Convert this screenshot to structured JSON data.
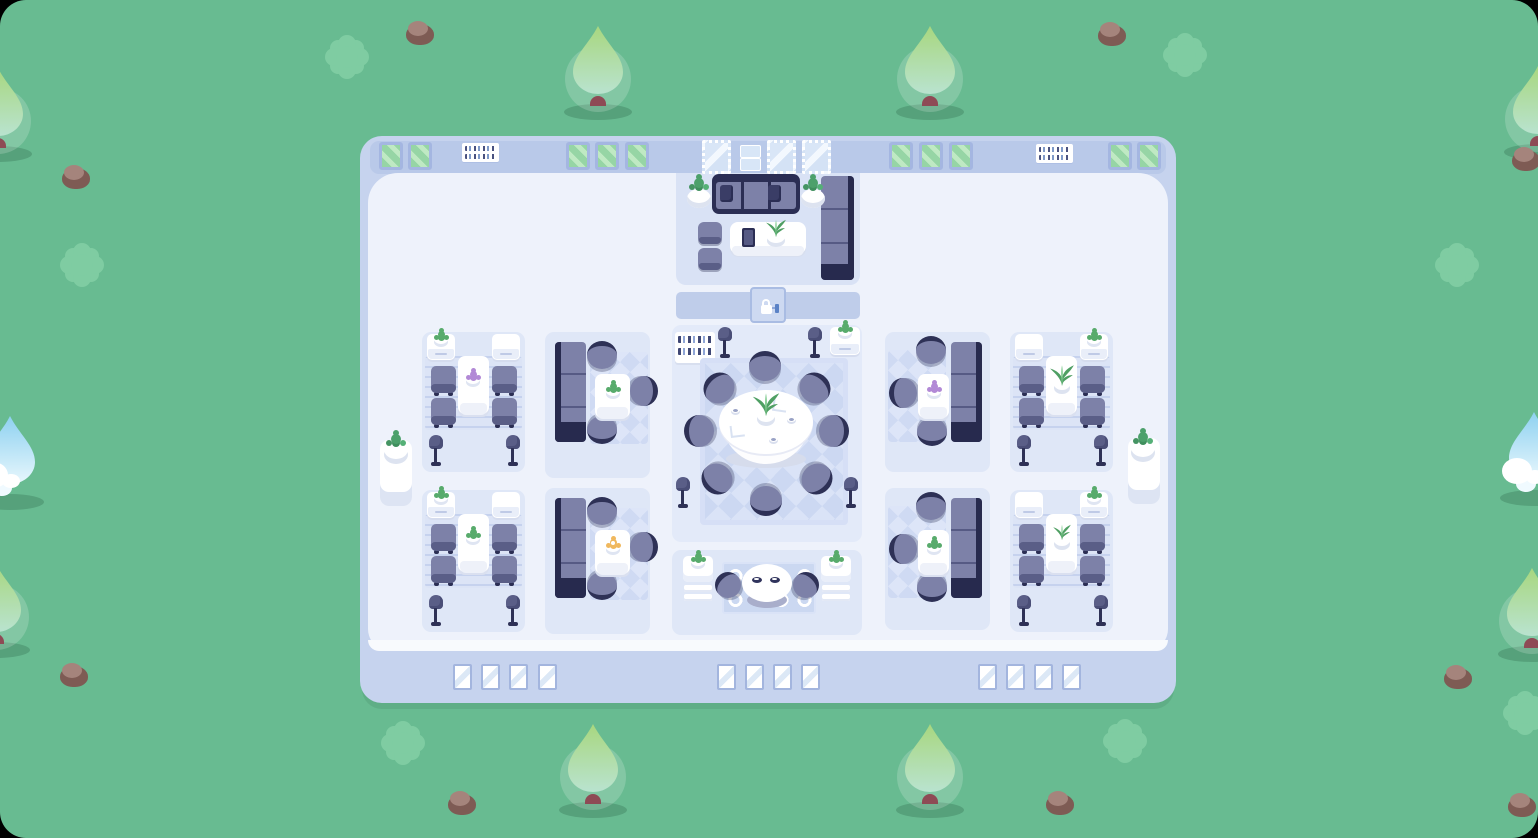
{
  "scene": {
    "title": "Top-down cozy office building on a grass field",
    "view": "top-down game map"
  },
  "environment": {
    "ground": "grass",
    "tree_count": 8,
    "cloud_tree_count": 2,
    "bush_count": 7,
    "rock_count": 9
  },
  "palette": {
    "grass": "#68BB91",
    "bush": "#7FCCA2",
    "tree_canopy_top": "#A8D77F",
    "tree_canopy_bottom": "#B9E3CF",
    "tree_trunk": "#8E4A55",
    "rock_light": "#A5847C",
    "rock_dark": "#7E5B54",
    "building_shell": "#C6D3EE",
    "wall_band": "#B9C9E9",
    "floor": "#EEF2FB",
    "room_panel": "#DFE7F7",
    "lounge_floor": "#D9E2F5",
    "window_green": "#96D5A5",
    "window_frame": "#A4B6E1",
    "furniture_purple": "#7D81A8",
    "furniture_navy": "#2B2E54",
    "table_white": "#FFFFFF",
    "plant_green": "#58AB6C",
    "flower_purple": "#B289D6",
    "flower_orange": "#F0B85E",
    "door_panel": "#CDD9F1",
    "door_handle_blue": "#5B82C6",
    "lock": "#FFFFFF"
  },
  "building": {
    "door": {
      "state": "locked",
      "icon": "padlock"
    },
    "top_wall": {
      "green_windows": 10,
      "vanity_mirrors": 3,
      "book_shelves": 2,
      "small_shelves": 2
    },
    "bottom_wall": {
      "window_groups": 3,
      "windows_per_group": 4
    },
    "plant_pedestals": 2,
    "rooms": [
      {
        "name": "lounge",
        "furniture": [
          "sofa with 2 pillows",
          "2 shrub pots",
          "coffee table",
          "tablet",
          "potted plant",
          "2 ottomans",
          "tall cabinet"
        ]
      },
      {
        "name": "dining-top-left",
        "furniture": [
          "2 cabinets (1 with plant)",
          "dining table with purple flowers",
          "4 chairs",
          "2 floor lamps",
          "striped rug"
        ]
      },
      {
        "name": "booth-top-left",
        "furniture": [
          "bookcase",
          "side table with green plant",
          "3 stools",
          "checkered rug"
        ]
      },
      {
        "name": "meeting",
        "furniture": [
          "bookshelf",
          "cabinet with plant",
          "4 floor lamps",
          "round conference table",
          "centerpiece plant",
          "2 paper stacks",
          "3 coffee cups",
          "8 chairs",
          "checkered rug"
        ]
      },
      {
        "name": "booth-top-right",
        "furniture": [
          "bookcase",
          "side table with purple flowers",
          "3 stools",
          "checkered rug"
        ]
      },
      {
        "name": "dining-top-right",
        "furniture": [
          "2 cabinets (1 with plant)",
          "dining table with agave plant",
          "4 chairs",
          "2 floor lamps",
          "striped rug"
        ]
      },
      {
        "name": "dining-bottom-left",
        "furniture": [
          "2 cabinets (1 with plant)",
          "dining table with green plant",
          "4 chairs",
          "2 floor lamps",
          "striped rug"
        ]
      },
      {
        "name": "booth-bottom-left",
        "furniture": [
          "bookcase",
          "side table with orange flower",
          "3 stools",
          "checkered rug"
        ]
      },
      {
        "name": "cafe",
        "furniture": [
          "2 dressers with plants",
          "round table with 2 place settings",
          "2 stools",
          "circle-pattern rug"
        ]
      },
      {
        "name": "booth-bottom-right",
        "furniture": [
          "bookcase",
          "side table with green plant",
          "3 stools",
          "checkered rug"
        ]
      },
      {
        "name": "dining-bottom-right",
        "furniture": [
          "2 cabinets (1 with plant)",
          "dining table with sprouts",
          "4 chairs",
          "2 floor lamps",
          "striped rug"
        ]
      }
    ]
  }
}
